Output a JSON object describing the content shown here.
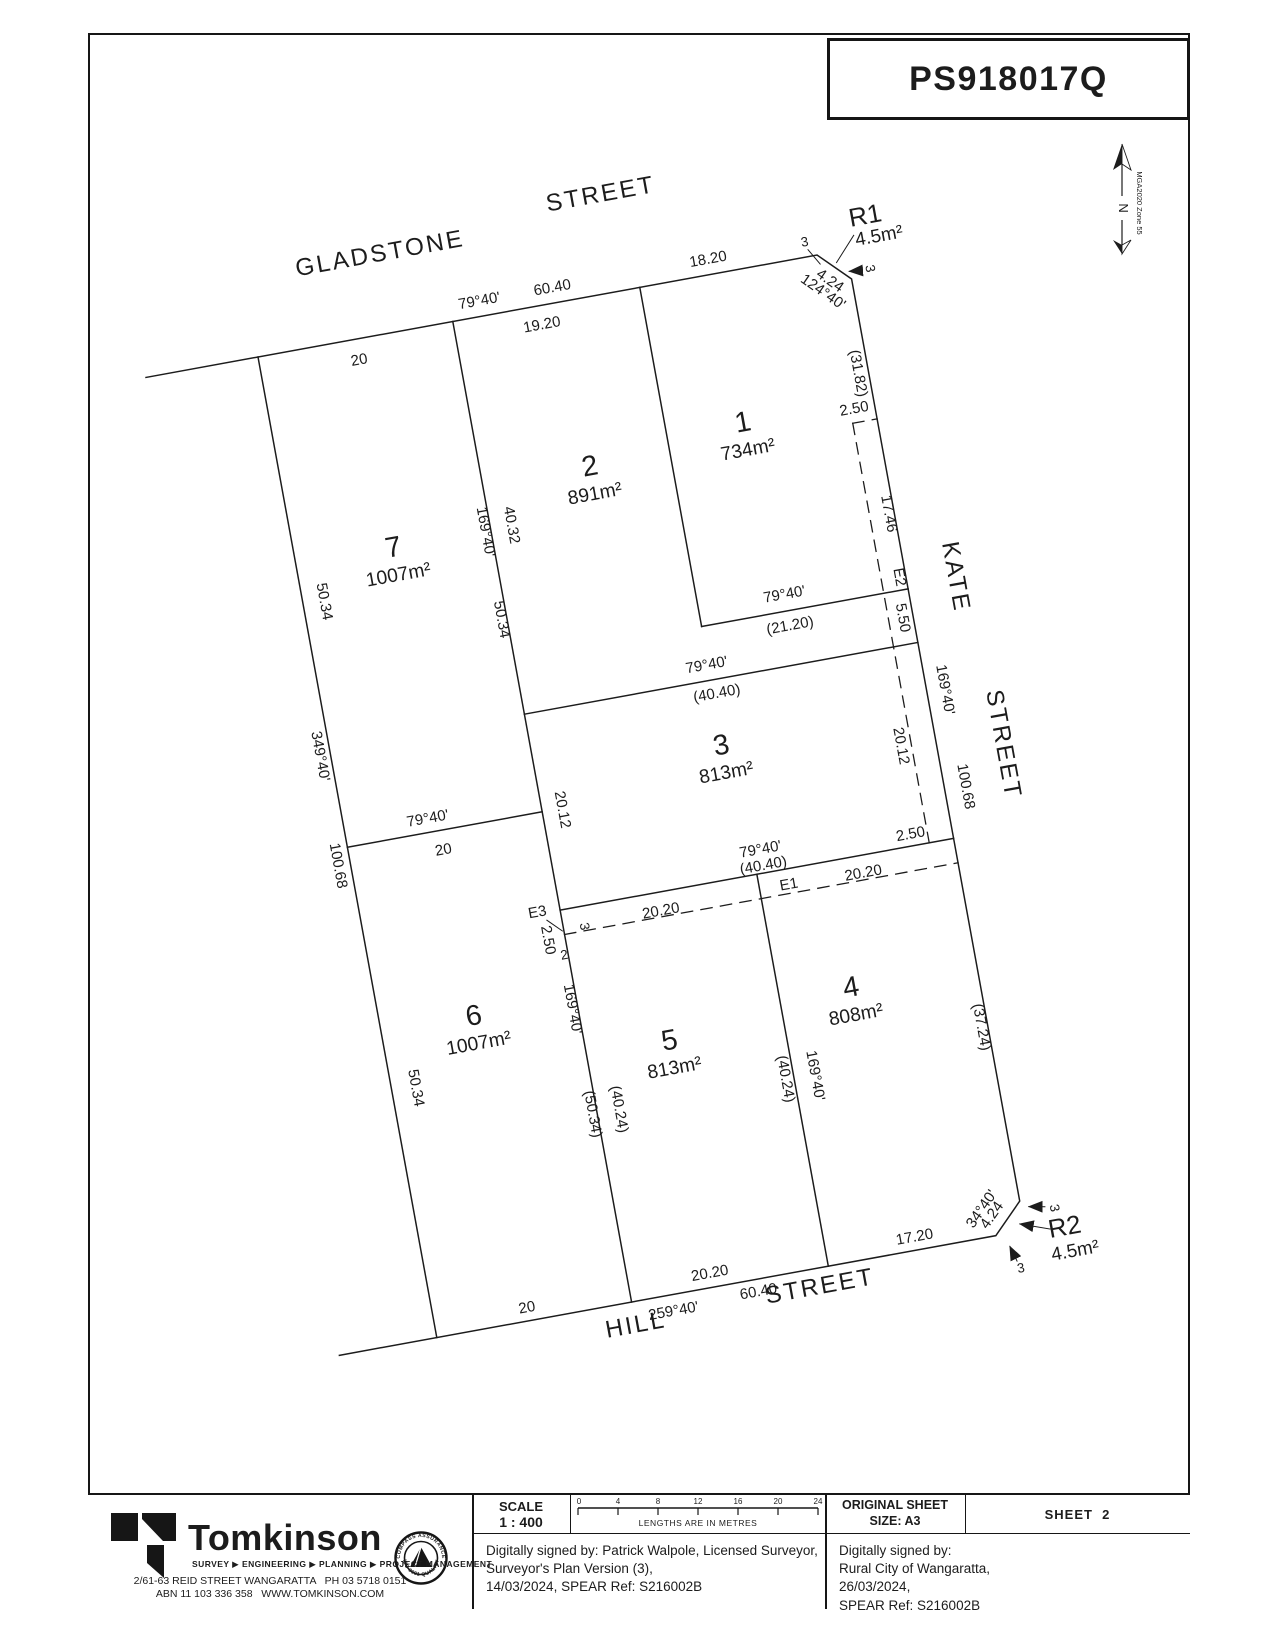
{
  "plan_ref": "PS918017Q",
  "north": {
    "label": "N",
    "datum": "MGA2020 Zone 55"
  },
  "streets": {
    "gladstone": "GLADSTONE",
    "gladstone_type": "STREET",
    "kate": "KATE",
    "kate_type": "STREET",
    "hill": "HILL",
    "hill_type": "STREET"
  },
  "lots": [
    {
      "num": "1",
      "area": "734m²"
    },
    {
      "num": "2",
      "area": "891m²"
    },
    {
      "num": "3",
      "area": "813m²"
    },
    {
      "num": "4",
      "area": "808m²"
    },
    {
      "num": "5",
      "area": "813m²"
    },
    {
      "num": "6",
      "area": "1007m²"
    },
    {
      "num": "7",
      "area": "1007m²"
    }
  ],
  "reserves": [
    {
      "num": "R1",
      "area": "4.5m²"
    },
    {
      "num": "R2",
      "area": "4.5m²"
    }
  ],
  "dims": {
    "top_bearing": "79°40'",
    "top_total": "60.40",
    "lot2_frontage": "19.20",
    "lot7_frontage": "20",
    "lot1_frontage": "18.20",
    "r1_splay": "4.24",
    "r1_splay_bearing": "124°40'",
    "r1_side_top": "3",
    "r1_side_east": "3",
    "lot1_kate": "(31.82)",
    "e2_offset": "2.50",
    "e2_upper": "17.46",
    "e2_label": "E2",
    "lot2_kate": "5.50",
    "lot1_south_bearing": "79°40'",
    "lot1_south": "(21.20)",
    "kate_bearing": "169°40'",
    "kate_total": "100.68",
    "e2_lower": "20.12",
    "e1_offset_east": "2.50",
    "lot3_north_bearing": "79°40'",
    "lot3_north": "(40.40)",
    "lot3_south_bearing": "79°40'",
    "lot3_south": "(40.40)",
    "e1_west": "20.20",
    "e1_label": "E1",
    "e1_east": "20.20",
    "e3_label": "E3",
    "e3_offset": "2.50",
    "e3_side": "3",
    "e3_width": "2",
    "west_upper": "50.34",
    "west_bearing": "349°40'",
    "west_total": "100.68",
    "west_lower": "50.34",
    "lot7_east_bearing": "169°40'",
    "lot2_west": "40.32",
    "lot7_east": "50.34",
    "mid_bearing": "79°40'",
    "mid_length": "20",
    "lot3_west": "20.12",
    "div65_bearing": "169°40'",
    "lot6_east": "(50.34)",
    "lot5_west": "(40.24)",
    "lot5_east": "(40.24)",
    "div54_bearing": "169°40'",
    "lot4_east": "(37.24)",
    "r2_splay_bearing": "34°40'",
    "r2_splay": "4.24",
    "r2_side_east": "3",
    "r2_side_bottom": "3",
    "lot4_frontage": "17.20",
    "lot6_frontage": "20",
    "bottom_bearing": "259°40'",
    "lot5_frontage": "20.20",
    "bottom_total": "60.40"
  },
  "titleblock": {
    "company": {
      "name": "Tomkinson",
      "tagline": "SURVEY ▶ ENGINEERING ▶ PLANNING ▶ PROJECT MANAGEMENT",
      "address1": "2/61-63 REID STREET WANGARATTA   PH 03 5718 0151",
      "address2": "ABN 11 103 336 358   WWW.TOMKINSON.COM"
    },
    "badge": {
      "top": "COMPASS ASSURANCE",
      "bottom": "ISO 9001 QUALITY"
    },
    "scale": {
      "label": "SCALE",
      "ratio": "1 : 400",
      "ticks": [
        "0",
        "4",
        "8",
        "12",
        "16",
        "20",
        "24"
      ],
      "units": "LENGTHS ARE IN METRES"
    },
    "original_sheet_line1": "ORIGINAL SHEET",
    "original_sheet_line2": "SIZE: A3",
    "sheet_label": "SHEET  2",
    "sig_left": {
      "line1": "Digitally signed by: Patrick Walpole, Licensed Surveyor,",
      "line2": "Surveyor's Plan Version (3),",
      "line3": "14/03/2024, SPEAR Ref: S216002B"
    },
    "sig_right": {
      "line1": "Digitally signed by:",
      "line2": "Rural City of Wangaratta,",
      "line3": "26/03/2024,",
      "line4": "SPEAR Ref: S216002B"
    }
  }
}
